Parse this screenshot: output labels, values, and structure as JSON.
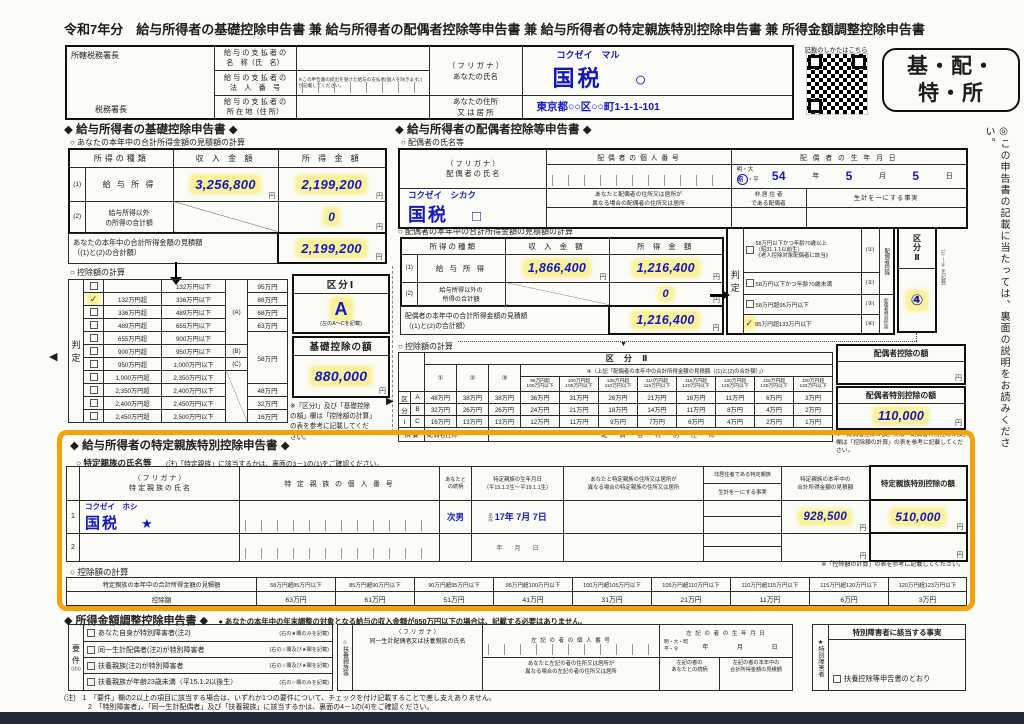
{
  "page": {
    "title": "令和7年分　給与所得者の基礎控除申告書 兼 給与所得者の配偶者控除等申告書 兼 給与所得者の特定親族特別控除申告書 兼 所得金額調整控除申告書"
  },
  "glyphs": {
    "check": "✓",
    "left_arrow": "◀",
    "right_arrow": "▶",
    "down_arrow": "▼"
  },
  "units": {
    "yen": "円"
  },
  "side_note": "◎この申告書の記載に当たっては、裏面の説明をお読みください。",
  "header": {
    "tax_office_top": "所轄税務署長",
    "tax_office_bottom": "税務署長",
    "payer_name_label": "給 与 の 支 払 者 の\n名　称（氏　名）",
    "payer_number_label": "給 与 の 支 払 者 の\n法　人　番　号",
    "payer_number_note": "※この申告書の提出を受けた給与の支払者(個人を除きます。)が記載してください。",
    "payer_address_label": "給 与 の 支 払 者 の\n所 在 地（住 所）",
    "your_name_label": "（ フ リ ガ ナ ）\nあなたの氏名",
    "your_furigana": "コクゼイ　マル",
    "your_name": "国税",
    "your_name_mark": "○",
    "your_address_label": "あなたの住所\n又 は 居 所",
    "your_address": "東京都○○区○○町1-1-1-101",
    "qr_caption": "記載のしかたはこちら",
    "badge": "基・配・\n特・所"
  },
  "basic": {
    "title": "◆ 給与所得者の基礎控除申告書 ◆",
    "calc_title": "○ あなたの本年中の合計所得金額の見積額の計算",
    "col_type": "所得の種類",
    "col_revenue": "収 入 金 額",
    "col_income": "所 得 金 額",
    "row1_no": "(1)",
    "row1_label": "給 与 所 得",
    "row1_revenue": "3,256,800",
    "row1_income": "2,199,200",
    "row2_no": "(2)",
    "row2_label": "給与所得以外\nの所得の合計額",
    "row2_income": "0",
    "total_label": "あなたの本年中の合計所得金額の見積額\n（(1)と(2)の合計額）",
    "total_value": "2,199,200",
    "ded_title": "○ 控除額の計算",
    "judge_char1": "判",
    "judge_char2": "定",
    "rows": [
      {
        "lo": "",
        "hi": "132万円以下",
        "mk": "",
        "amt": "95万円"
      },
      {
        "lo": "132万円超",
        "hi": "336万円以下",
        "mk": "",
        "amt": "88万円"
      },
      {
        "lo": "336万円超",
        "hi": "489万円以下",
        "mk": "(A)",
        "amt": "68万円"
      },
      {
        "lo": "489万円超",
        "hi": "655万円以下",
        "mk": "",
        "amt": "63万円"
      },
      {
        "lo": "655万円超",
        "hi": "900万円以下",
        "mk": "",
        "amt": "58万円"
      },
      {
        "lo": "900万円超",
        "hi": "950万円以下",
        "mk": "(B)",
        "amt": ""
      },
      {
        "lo": "950万円超",
        "hi": "1,000万円以下",
        "mk": "(C)",
        "amt": ""
      },
      {
        "lo": "1,000万円超",
        "hi": "2,350万円以下",
        "mk": "",
        "amt": ""
      },
      {
        "lo": "2,350万円超",
        "hi": "2,400万円以下",
        "mk": "",
        "amt": "48万円"
      },
      {
        "lo": "2,400万円超",
        "hi": "2,450万円以下",
        "mk": "",
        "amt": "32万円"
      },
      {
        "lo": "2,450万円超",
        "hi": "2,500万円以下",
        "mk": "",
        "amt": "16万円"
      }
    ],
    "kubun1_title": "区分Ⅰ",
    "kubun1_value": "A",
    "kubun1_note": "(左のA～Cを記載)",
    "amount_title": "基礎控除の額",
    "amount_value": "880,000",
    "note": "※「区分Ⅰ」及び「基礎控除\nの額」欄は「控除額の計算」\nの表を参考に記載してくだ\nさい。"
  },
  "spouse": {
    "title": "◆ 給与所得者の配偶者控除等申告書 ◆",
    "name_title": "○ 配偶者の氏名等",
    "name_label": "（ フ リ ガ ナ ）\n配 偶 者 の 氏 名",
    "furigana": "コクゼイ　シカク",
    "name": "国税",
    "name_mark": "□",
    "mynumber_label": "配 偶 者 の 個 人 番 号",
    "birthday_label": "配 偶 者 の 生 年 月 日",
    "era_top": "明・大",
    "era_sel": "昭",
    "era_after": "・平",
    "birth_year": "54",
    "y_label": "年",
    "birth_month": "5",
    "m_label": "月",
    "birth_day": "5",
    "d_label": "日",
    "address_label": "あなたと配偶者の住所又は居所が\n異なる場合の配偶者の住所又は居所",
    "nonres_label": "非 居 住 者\nである配偶者",
    "living_label": "生計を一にする事実",
    "calc_title": "○ 配偶者の本年中の合計所得金額の見積額の計算",
    "col_type": "所得の種類",
    "col_revenue": "収 入 金 額",
    "col_income": "所 得 金 額",
    "row1_no": "(1)",
    "row1_label": "給 与 所 得",
    "row1_revenue": "1,866,400",
    "row1_income": "1,216,400",
    "row2_no": "(2)",
    "row2_label": "給与所得以外の\n所得の合計額",
    "row2_income": "0",
    "total_label": "配偶者の本年中の合計所得金額の見積額\n（(1)と(2)の合計額）",
    "total_value": "1,216,400",
    "judge_char1": "判",
    "judge_char2": "定",
    "jrows": [
      {
        "label": "58万円以下かつ年齢70歳以上\n（昭31.1.1以前生）\n《老人控除対象配偶者に該当》",
        "mk": "(①)"
      },
      {
        "label": "58万円以下かつ年齢70歳未満",
        "mk": "(②)"
      },
      {
        "label": "58万円超95万円以下",
        "mk": "(③)"
      },
      {
        "label": "95万円超133万円以下",
        "mk": "(④)"
      }
    ],
    "side1": "配偶者控除",
    "side2": "配偶者特別控除",
    "kubun2_title": "区\n分\nⅡ",
    "kubun2_value": "④",
    "kubun2_note": "(①～④を記載)",
    "ded_title": "○ 控除額の計算",
    "t_kubun2": "区 分 Ⅱ",
    "t_c1": "①",
    "t_c2": "②",
    "t_c3": "③",
    "t_c4": "④（上記「配偶者の本年中の合計所得金額の見積額（(1)と(2)の合計額）」）",
    "sub": [
      "95万円超\n100万円以下",
      "100万円超\n105万円以下",
      "105万円超\n110万円以下",
      "110万円超\n115万円以下",
      "115万円超\n120万円以下",
      "120万円超\n125万円以下",
      "125万円超\n130万円以下",
      "130万円超\n133万円以下"
    ],
    "rl1": "区",
    "rl2": "分",
    "rl3": "Ⅰ",
    "rows": [
      {
        "k": "A",
        "v": [
          "48万円",
          "38万円",
          "38万円",
          "36万円",
          "31万円",
          "26万円",
          "21万円",
          "16万円",
          "11万円",
          "6万円",
          "3万円"
        ]
      },
      {
        "k": "B",
        "v": [
          "32万円",
          "26万円",
          "26万円",
          "24万円",
          "21万円",
          "18万円",
          "14万円",
          "11万円",
          "8万円",
          "4万円",
          "2万円"
        ]
      },
      {
        "k": "C",
        "v": [
          "16万円",
          "13万円",
          "13万円",
          "12万円",
          "11万円",
          "9万円",
          "7万円",
          "6万円",
          "4万円",
          "2万円",
          "1万円"
        ]
      }
    ],
    "sum_label": "摘 要",
    "sum1": "配偶者控除",
    "sum2": "配 偶 者 特 別 控 除",
    "ded1_title": "配偶者控除の額",
    "ded1_value": "",
    "ded2_title": "配偶者特別控除の額",
    "ded2_value": "110,000",
    "note": "※「配偶者控除の額」又は「配偶者特別控除の額」欄は「控除額の計算」の表を参考に記載してください。"
  },
  "tokutei": {
    "title": "◆ 給与所得者の特定親族特別控除申告書 ◆",
    "name_title": "○ 特定親族の氏名等",
    "name_note": "(注)「特定親族」に該当するかは、裏面の3－1の(1)をご確認ください。",
    "h_name": "（ フ リ ガ ナ ）\n特 定 親 族 の 氏 名",
    "h_number": "特 定 親 族 の 個 人 番 号",
    "h_rel": "あなたと\nの続柄",
    "h_birth": "特定親族の生年月日\n（平15.1.2生～平19.1.1生）",
    "h_addr": "あなたと特定親族の住所又は居所が\n異なる場合の特定親族の住所又は居所",
    "h_nonres": "非居住者である特定親族",
    "h_living": "生計を一にする事実",
    "h_income": "特定親族の本年中の\n合計所得金額の見積額",
    "h_ded": "特定親族特別控除の額",
    "r1_no": "1",
    "r1_furigana": "コクゼイ　ホシ",
    "r1_name": "国税",
    "r1_mark": "★",
    "r1_rel": "次男",
    "r1_era": "平\n成",
    "r1_birth": "17年  7月  7日",
    "r1_income": "928,500",
    "r1_ded": "510,000",
    "r2_no": "2",
    "r2_birth": "年　　月　　日",
    "ref_note": "※「控除額の計算」の表を参考に記載してください。",
    "calc_title": "○ 控除額の計算",
    "calc_label": "特定親族の本年中の合計所得金額の見積額",
    "ranges": [
      "58万円超85万円以下",
      "85万円超90万円以下",
      "90万円超95万円以下",
      "95万円超100万円以下",
      "100万円超105万円以下",
      "105万円超110万円以下",
      "110万円超115万円以下",
      "115万円超120万円以下",
      "120万円超123万円以下"
    ],
    "amount_label": "控除額",
    "amounts": [
      "63万円",
      "61万円",
      "51万円",
      "41万円",
      "31万円",
      "21万円",
      "11万円",
      "6万円",
      "3万円"
    ]
  },
  "adjust": {
    "title": "◆ 所得金額調整控除申告書 ◆",
    "subtitle": "● あなたの本年中の年末調整の対象となる給与の収入金額が850万円以下の場合は、記載する必要はありません。",
    "req_label": "要\n件",
    "req_note_label": "(注1)",
    "reqs": [
      {
        "label": "あなた自身が特別障害者(注2)",
        "note": "(右の★欄のみを記載)"
      },
      {
        "label": "同一生計配偶者(注2)が特別障害者",
        "note": "(右の☆欄及び★欄を記載)"
      },
      {
        "label": "扶養親族(注2)が特別障害者",
        "note": "(右の☆欄及び★欄を記載)"
      },
      {
        "label": "扶養親族が年齢23歳未満（平15.1.2以後生）",
        "note": "(右の☆欄のみを記載)"
      }
    ],
    "fuyou_label": "☆扶養親族等",
    "fuyou_name_label": "（ フ リ ガ ナ ）\n同一生計配偶者又は扶養親族の氏名",
    "number_label": "左 記 の 者 の 個 人 番 号",
    "birth_label": "左 記 の 者 の 生 年 月 日",
    "era1": "明・大・昭",
    "era2": "平・令",
    "y": "年",
    "m": "月",
    "d": "日",
    "addr_label": "あなたと左記の者の住所又は居所が\n異なる場合の左記の者の住所又は居所",
    "rel_label": "左記の者の\nあなたとの続柄",
    "income_label": "左記の者の本年中の\n合計所得金額の見積額",
    "star_label": "★特別障害者",
    "fact_title": "特別障害者に該当する事実",
    "fact_check": "扶養控除等申告書のとおり",
    "note1": "(注)　1　「要件」欄の2以上の項目に該当する場合は、いずれか1つの要件について、チェックを付け記載することで差し支えありません。",
    "note2": "2　「特別障害者」、「同一生計配偶者」及び「扶養親族」に該当するかは、裏面の4－1の(4)をご確認ください。"
  }
}
